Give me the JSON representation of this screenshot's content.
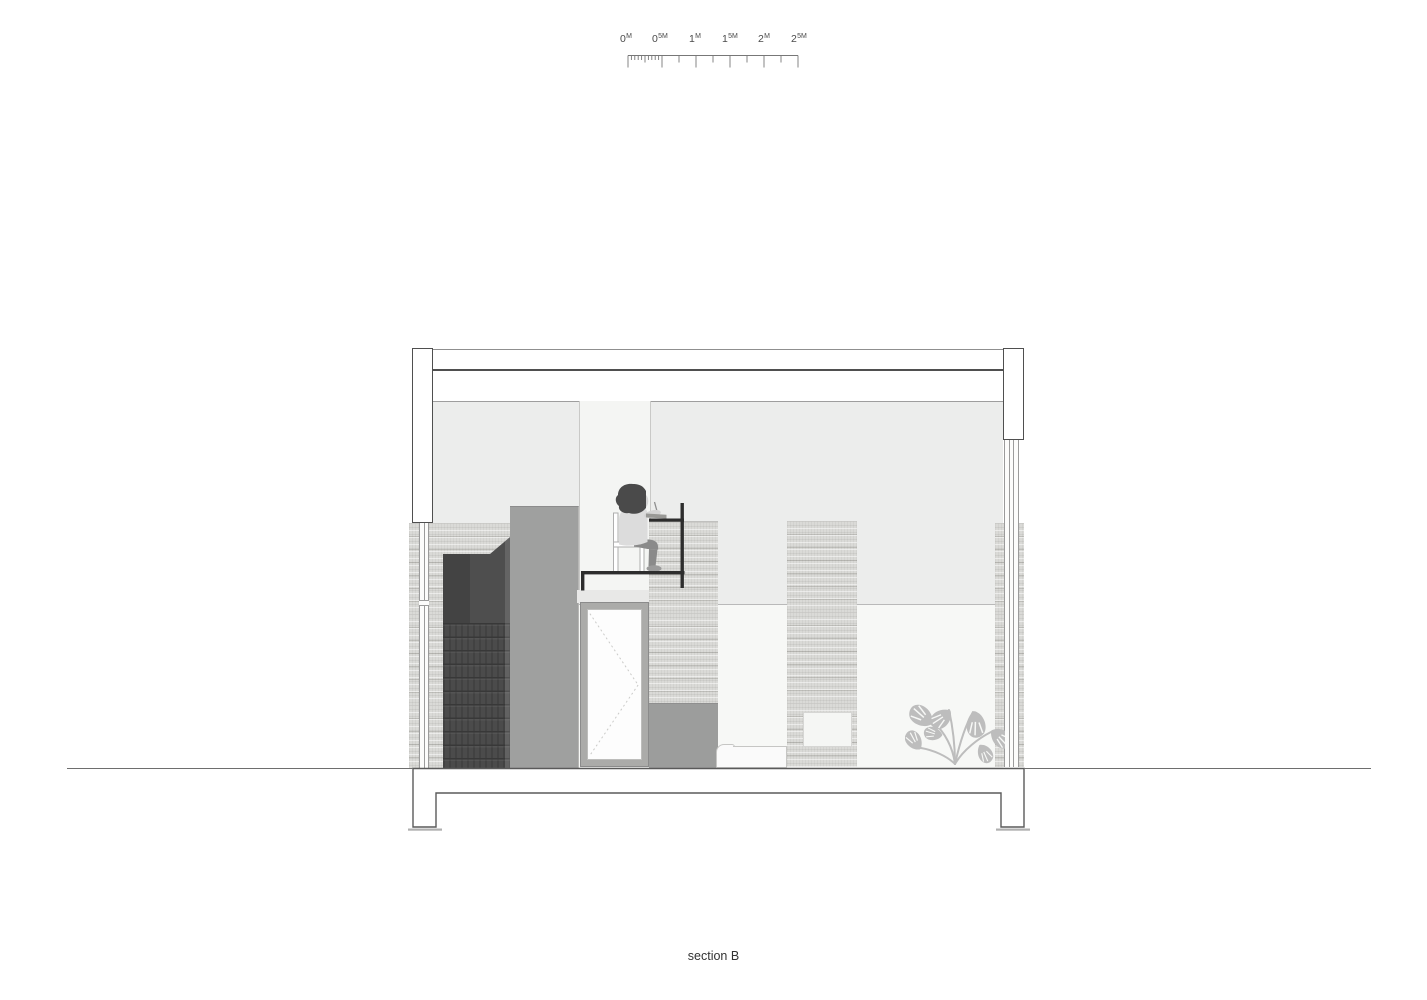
{
  "title": {
    "caption": "section B"
  },
  "scale_bar": {
    "name": "scale-bar",
    "total_meters": 2.5,
    "major_interval_meters": 0.5,
    "labels": [
      {
        "base": "0",
        "sup": "M"
      },
      {
        "base": "0",
        "sup": "5M"
      },
      {
        "base": "1",
        "sup": "M"
      },
      {
        "base": "1",
        "sup": "5M"
      },
      {
        "base": "2",
        "sup": "M"
      },
      {
        "base": "2",
        "sup": "5M"
      }
    ]
  },
  "drawing": {
    "type": "architectural-section",
    "elements": [
      "roof-slab",
      "left-wall-post",
      "right-wall-post",
      "clerestory-glazing",
      "side-window-mullions",
      "wood-cladding",
      "staircase",
      "storage-volume",
      "mezzanine-floor-frame",
      "desk",
      "chair",
      "person-sitting",
      "tablet",
      "door",
      "wood-panel",
      "wall-niche",
      "low-cabinet",
      "sofa",
      "monstera-plant",
      "foundation-footings",
      "ground-line"
    ]
  },
  "colors": {
    "line_dark": "#4f4f4f",
    "roof_line": "#8f8f8f",
    "interior_upper": "#ecedec",
    "interior_lower": "#f7f8f6",
    "white_column": "#f4f5f3",
    "wood_light": "#dadad7",
    "volume_gray": "#9fa09f",
    "cabinet_gray": "#9c9d9c",
    "door_frame": "#ababa9",
    "door_panel": "#fdfdfd",
    "stair_dark": "#4b4b4b",
    "frame_black": "#2d2d2d",
    "person_hair": "#4a4a4a",
    "person_shirt": "#dcdcdc",
    "person_pants": "#8a8a8a",
    "person_skin": "#d4d4d4",
    "plant": "#bdbdbd",
    "sofa_fill": "#fafafa",
    "sofa_outline": "#c6c6c4",
    "glass_line": "#9b9b9b",
    "ground_line": "#6e6e6e",
    "text": "#333333"
  }
}
